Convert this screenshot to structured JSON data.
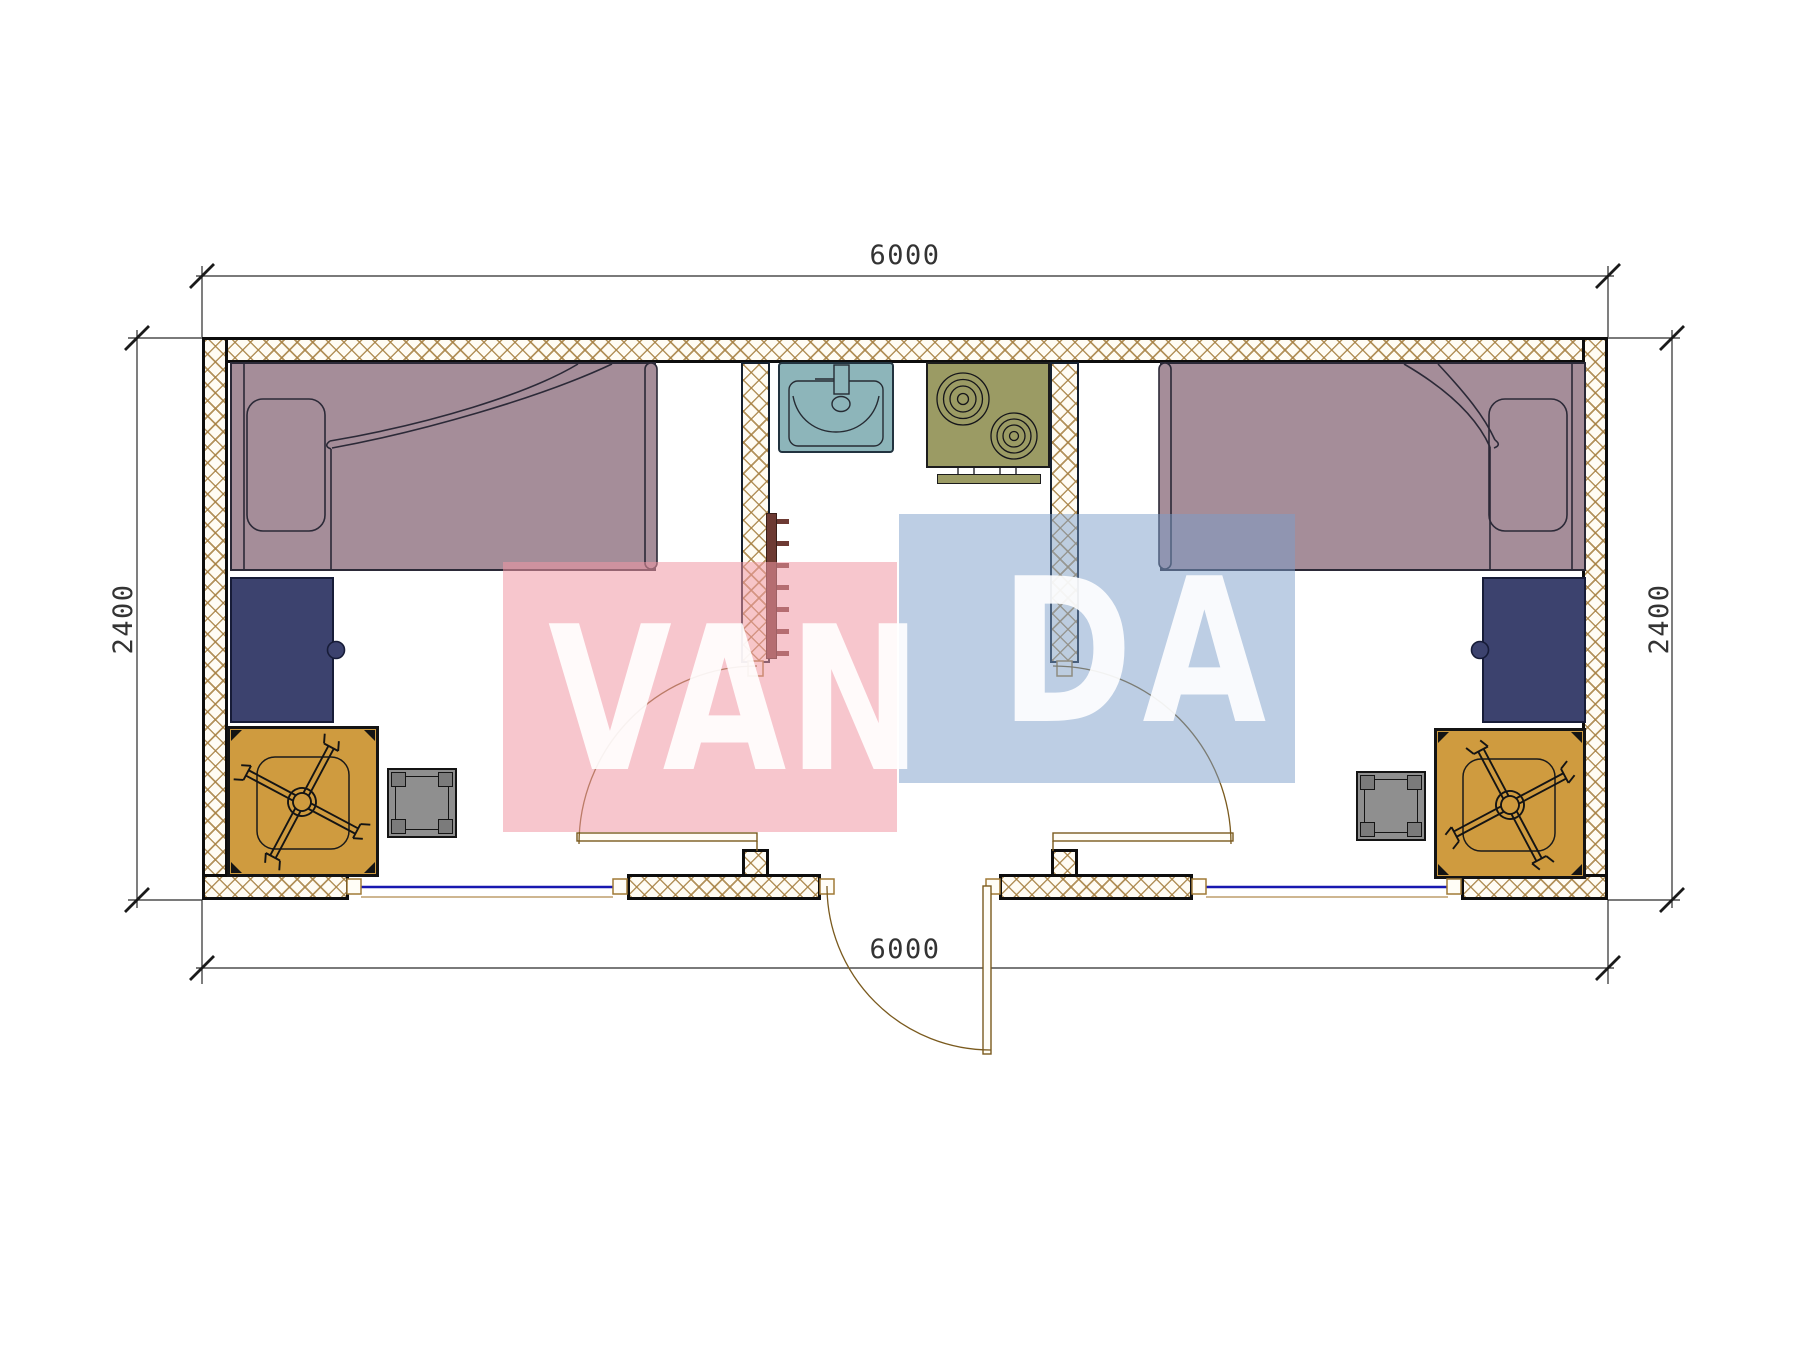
{
  "page": {
    "type": "architectural-floor-plan",
    "background": "#ffffff"
  },
  "dimensions": {
    "top": "6000",
    "bottom": "6000",
    "left": "2400",
    "right": "2400"
  },
  "watermark": {
    "full_text": "VANDA",
    "segment_pink": "VAN",
    "segment_blue": "DA"
  },
  "rooms": {
    "left": [
      "bed",
      "desk",
      "table-with-office-chair",
      "stool"
    ],
    "middle": [
      "sink",
      "stove",
      "towel-rail"
    ],
    "right": [
      "bed",
      "desk",
      "table-with-office-chair",
      "stool"
    ]
  },
  "palette": {
    "wall_hatch": "rgba(166,128,66,0.85)",
    "bed": "#a58d99",
    "desk": "#3c426e",
    "table": "#cf9b3f",
    "stool": "#8f8f8f",
    "sink": "#8db5ba",
    "stove": "#9b9b64",
    "rail": "#6d3a33",
    "window": "#1818b0",
    "door": "#7a5a1e",
    "line": "#2a2a2a",
    "pink_overlay": "rgba(240,151,164,0.55)",
    "blue_overlay": "rgba(124,157,201,0.50)",
    "watermark_text": "rgba(255,255,255,0.90)"
  }
}
